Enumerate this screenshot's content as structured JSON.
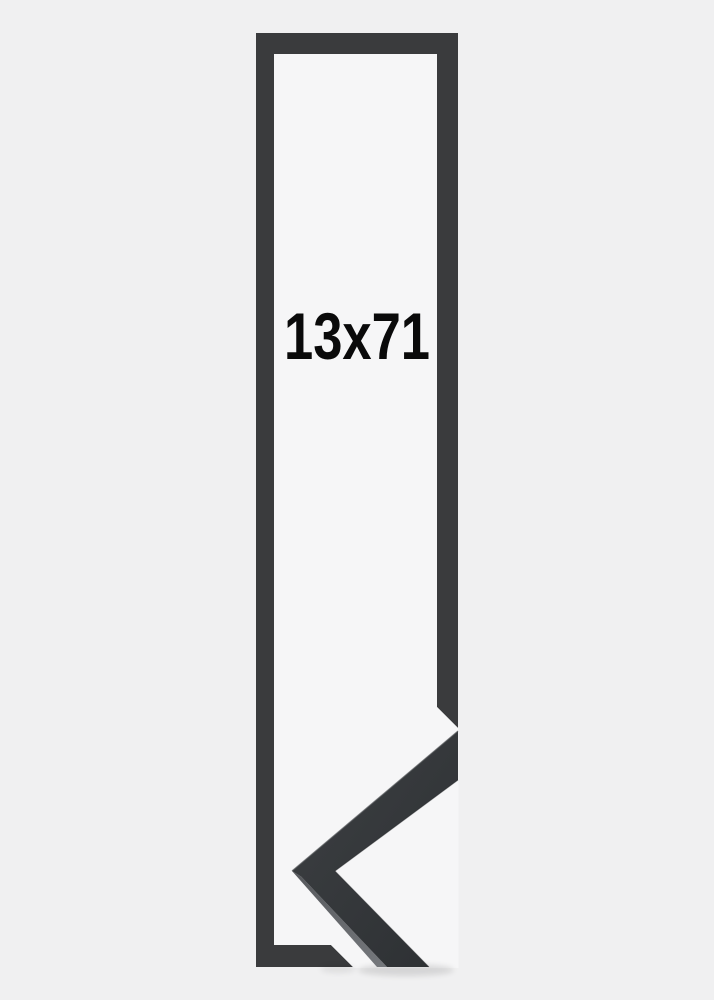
{
  "product_image": {
    "size_label": "13x71",
    "description_names": {
      "outline": "frame-size-outline",
      "corner_sample": "frame-corner-sample-photo"
    }
  },
  "colors": {
    "background": "#f0f0f1",
    "inner_background": "#f6f6f7",
    "outline_bar": "#3a3b3d",
    "sample_face_light": "#3b3e41",
    "sample_face_dark": "#2e3134",
    "sample_side_light": "#75787c",
    "sample_side_dark": "#57595d",
    "label_color": "#0a0a0a"
  }
}
